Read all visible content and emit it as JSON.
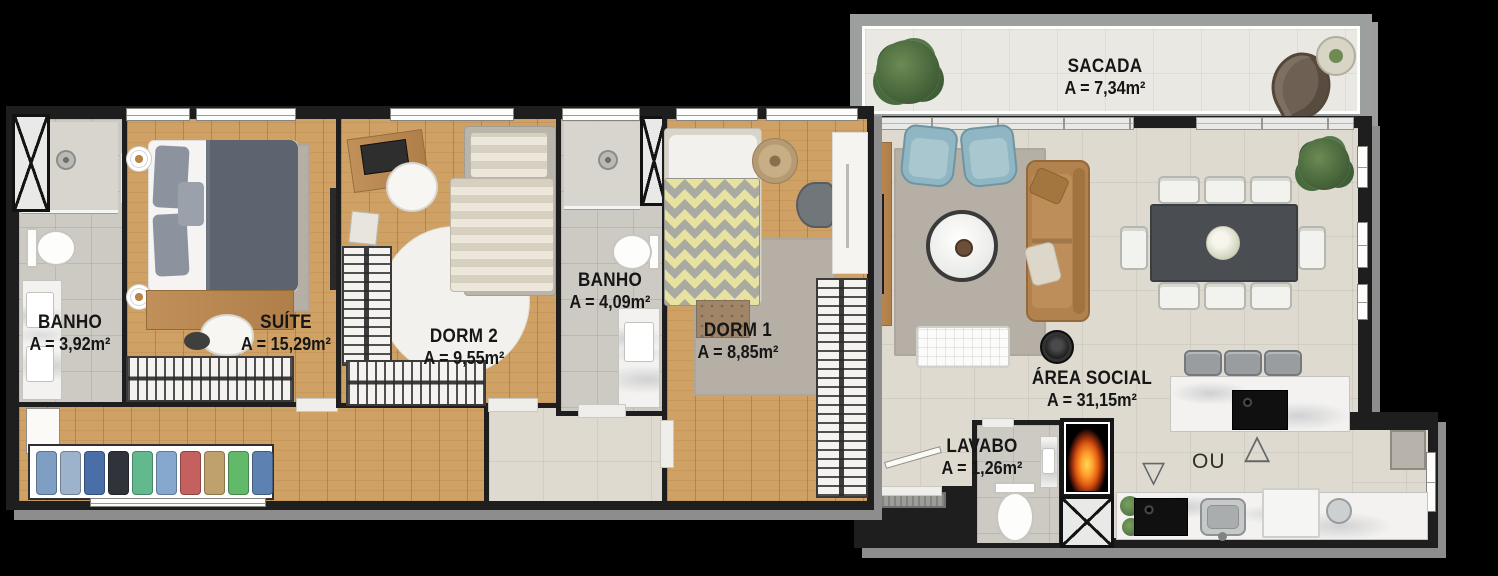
{
  "plan": {
    "type": "apartment-floor-plan"
  },
  "rooms": {
    "banho_suite": {
      "name": "BANHO",
      "area": "A = 3,92m²"
    },
    "suite": {
      "name": "SUÍTE",
      "area": "A = 15,29m²"
    },
    "dorm2": {
      "name": "DORM 2",
      "area": "A = 9,55m²"
    },
    "banho_social": {
      "name": "BANHO",
      "area": "A = 4,09m²"
    },
    "dorm1": {
      "name": "DORM 1",
      "area": "A = 8,85m²"
    },
    "sacada": {
      "name": "SACADA",
      "area": "A = 7,34m²"
    },
    "area_social": {
      "name": "ÁREA SOCIAL",
      "area": "A = 31,15m²"
    },
    "lavabo": {
      "name": "LAVABO",
      "area": "A = 1,26m²"
    }
  },
  "annotations": {
    "kitchen_alternative": "OU",
    "triangle_up": "△",
    "triangle_down": "▽"
  },
  "closet": {
    "items": [
      "#7f9ec4",
      "#9db3cc",
      "#4a6ea8",
      "#30343a",
      "#62b98e",
      "#86a8cf",
      "#c4605e",
      "#bfa26b",
      "#63b96a",
      "#5d81b0"
    ]
  },
  "colors": {
    "wall": "#1e1e1e",
    "wood_floor": "#cfa164",
    "tile_social": "#dedacf",
    "tile_bath": "#cdcac4",
    "tile_balcony": "#eae8e3",
    "sofa": "#b2824e",
    "armchair": "#8fb6c2",
    "dining_table": "#4a4e52",
    "rug": "#b6afa6"
  }
}
